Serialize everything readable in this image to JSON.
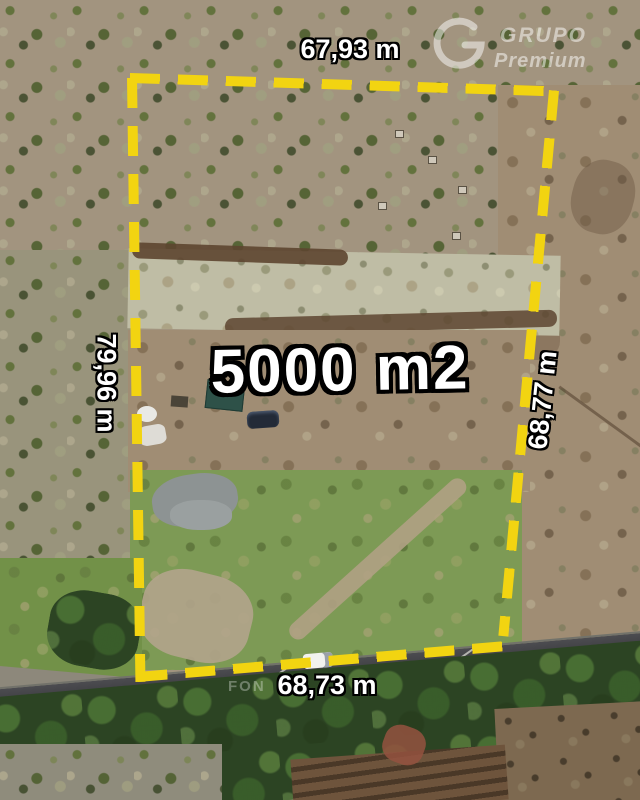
{
  "photo": {
    "area_label": "5000 m2",
    "measurements": {
      "top": "67,93 m",
      "left": "79,96 m",
      "right": "68,77 m",
      "bottom": "68,73 m"
    },
    "watermark": {
      "line1": "GRUPO",
      "line2": "Premium",
      "partial": "FON"
    },
    "colors": {
      "boundary_yellow": "#f2d411",
      "label_text": "#ffffff",
      "label_outline": "#000000",
      "grass": "#7d9a55",
      "road": "#3a3a3e",
      "trees": "#2c4423"
    }
  }
}
